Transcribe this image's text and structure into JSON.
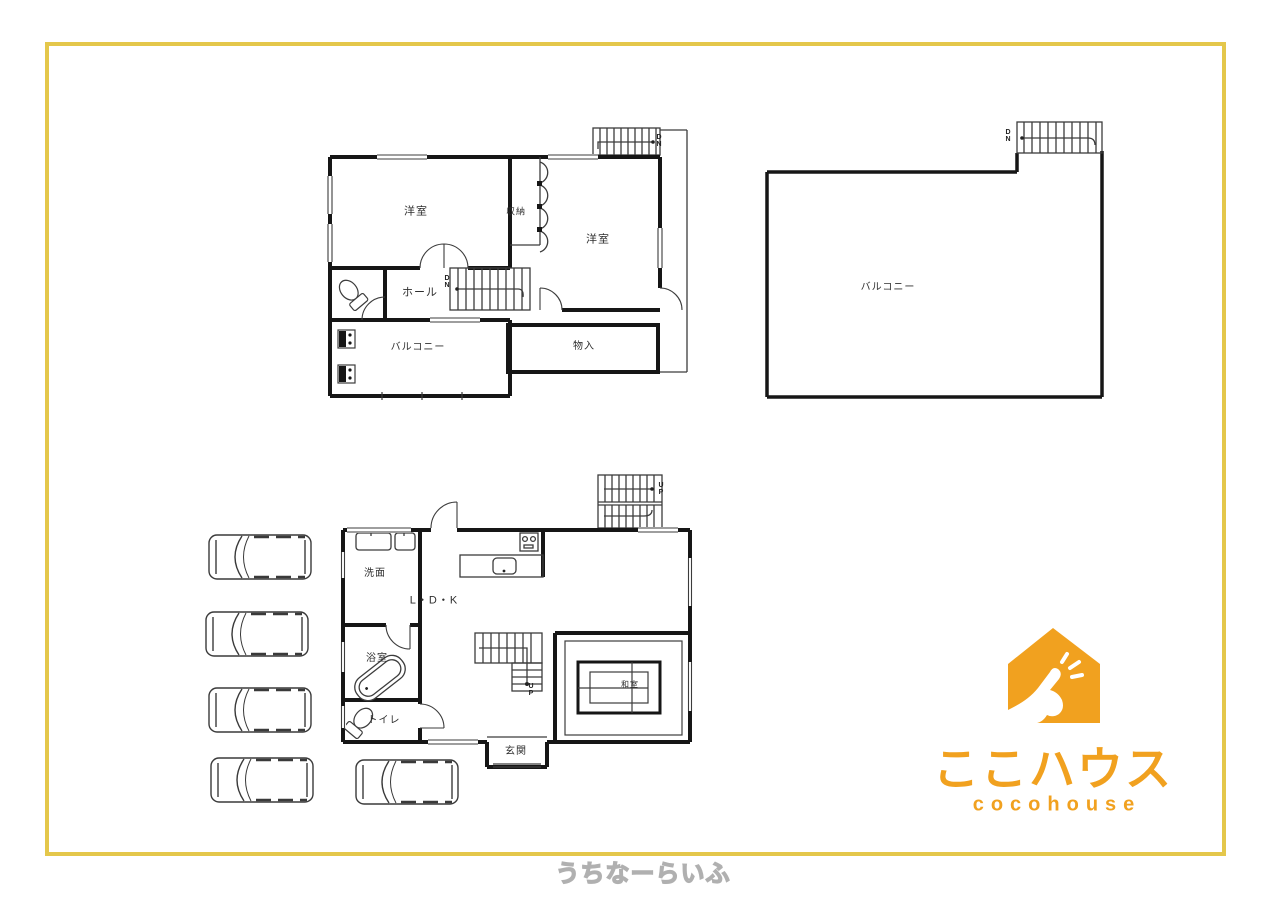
{
  "frame": {
    "border_color": "#e4c74b"
  },
  "second_floor": {
    "bedroom_a": "洋室",
    "closet": "収納",
    "bedroom_b": "洋室",
    "hall": "ホール",
    "balcony": "バルコニー",
    "storage": "物入",
    "stairs_internal": "DN",
    "stairs_external": "DN"
  },
  "roof_balcony": {
    "balcony": "バルコニー",
    "stairs": "DN"
  },
  "first_floor": {
    "washroom": "洗面",
    "ldk": "L・D・K",
    "bathroom": "浴室",
    "toilet": "トイレ",
    "entrance": "玄関",
    "japanese_room": "和室",
    "stairs_external": "UP",
    "stairs_internal": "UP"
  },
  "parking": {
    "car_count": 5
  },
  "logo": {
    "name_jp": "ここハウス",
    "name_en": "cocohouse",
    "accent_color": "#f1a11f"
  },
  "watermark": {
    "text": "うちなーらいふ"
  }
}
